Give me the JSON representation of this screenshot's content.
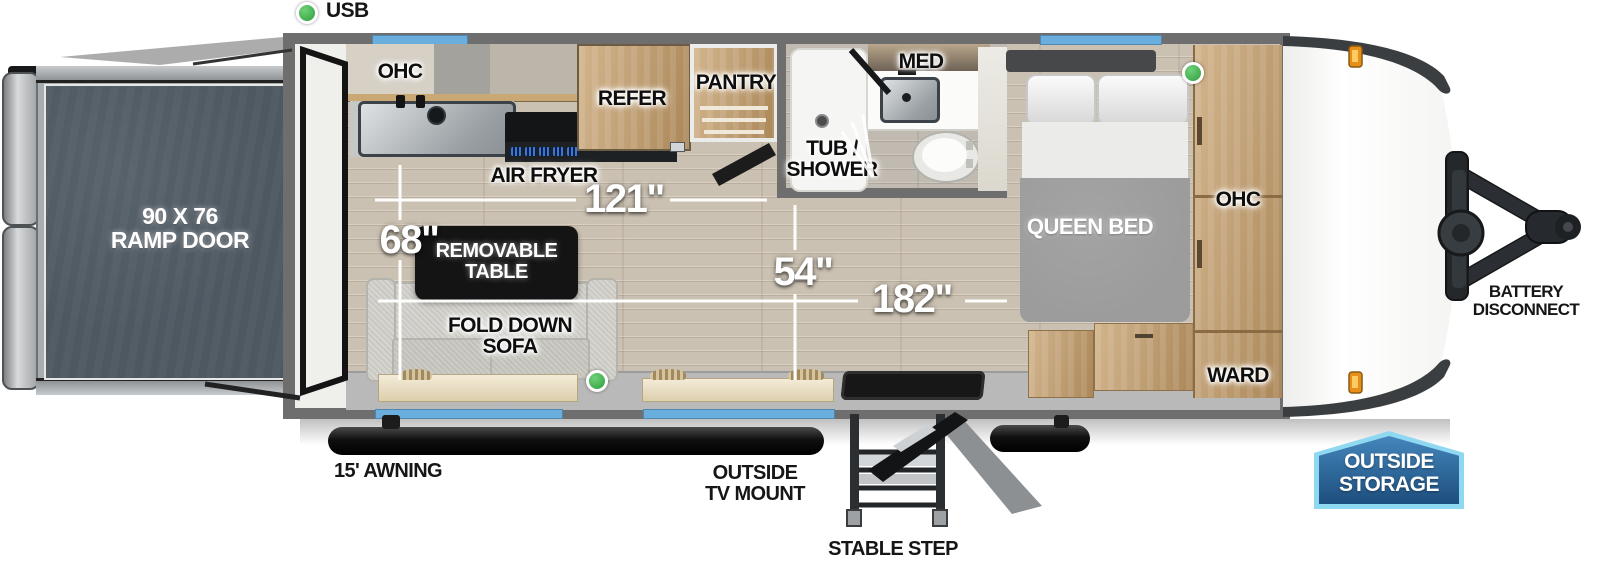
{
  "legend": {
    "usb": "USB"
  },
  "ramp_door": {
    "line1": "90 X 76",
    "line2": "RAMP DOOR"
  },
  "kitchen": {
    "ohc": "OHC",
    "air_fryer": "AIR FRYER",
    "refer": "REFER",
    "pantry": "PANTRY"
  },
  "bathroom": {
    "tub1": "TUB /",
    "tub2": "SHOWER",
    "med": "MED"
  },
  "bedroom": {
    "queen_bed": "QUEEN BED",
    "ohc": "OHC",
    "ward": "WARD"
  },
  "living": {
    "table1": "REMOVABLE",
    "table2": "TABLE",
    "sofa": "FOLD DOWN SOFA"
  },
  "dimensions": {
    "kitchen_run": "121\"",
    "sofa": "68\"",
    "walkway": "54\"",
    "main_room": "182\""
  },
  "exterior": {
    "awning": "15' AWNING",
    "tv1": "OUTSIDE",
    "tv2": "TV MOUNT",
    "step": "STABLE STEP",
    "battery1": "BATTERY",
    "battery2": "DISCONNECT",
    "storage1": "OUTSIDE",
    "storage2": "STORAGE"
  },
  "colors": {
    "window_blue": "#6aaede",
    "usb_green": "#3fae49",
    "marker_orange": "#f29c1f",
    "badge_blue": "#2a629c",
    "badge_border": "#8fd8f2",
    "ramp_slate": "#4d5861",
    "wall_gray": "#6e6e6e",
    "cabinet_wood": "#c2a278"
  }
}
